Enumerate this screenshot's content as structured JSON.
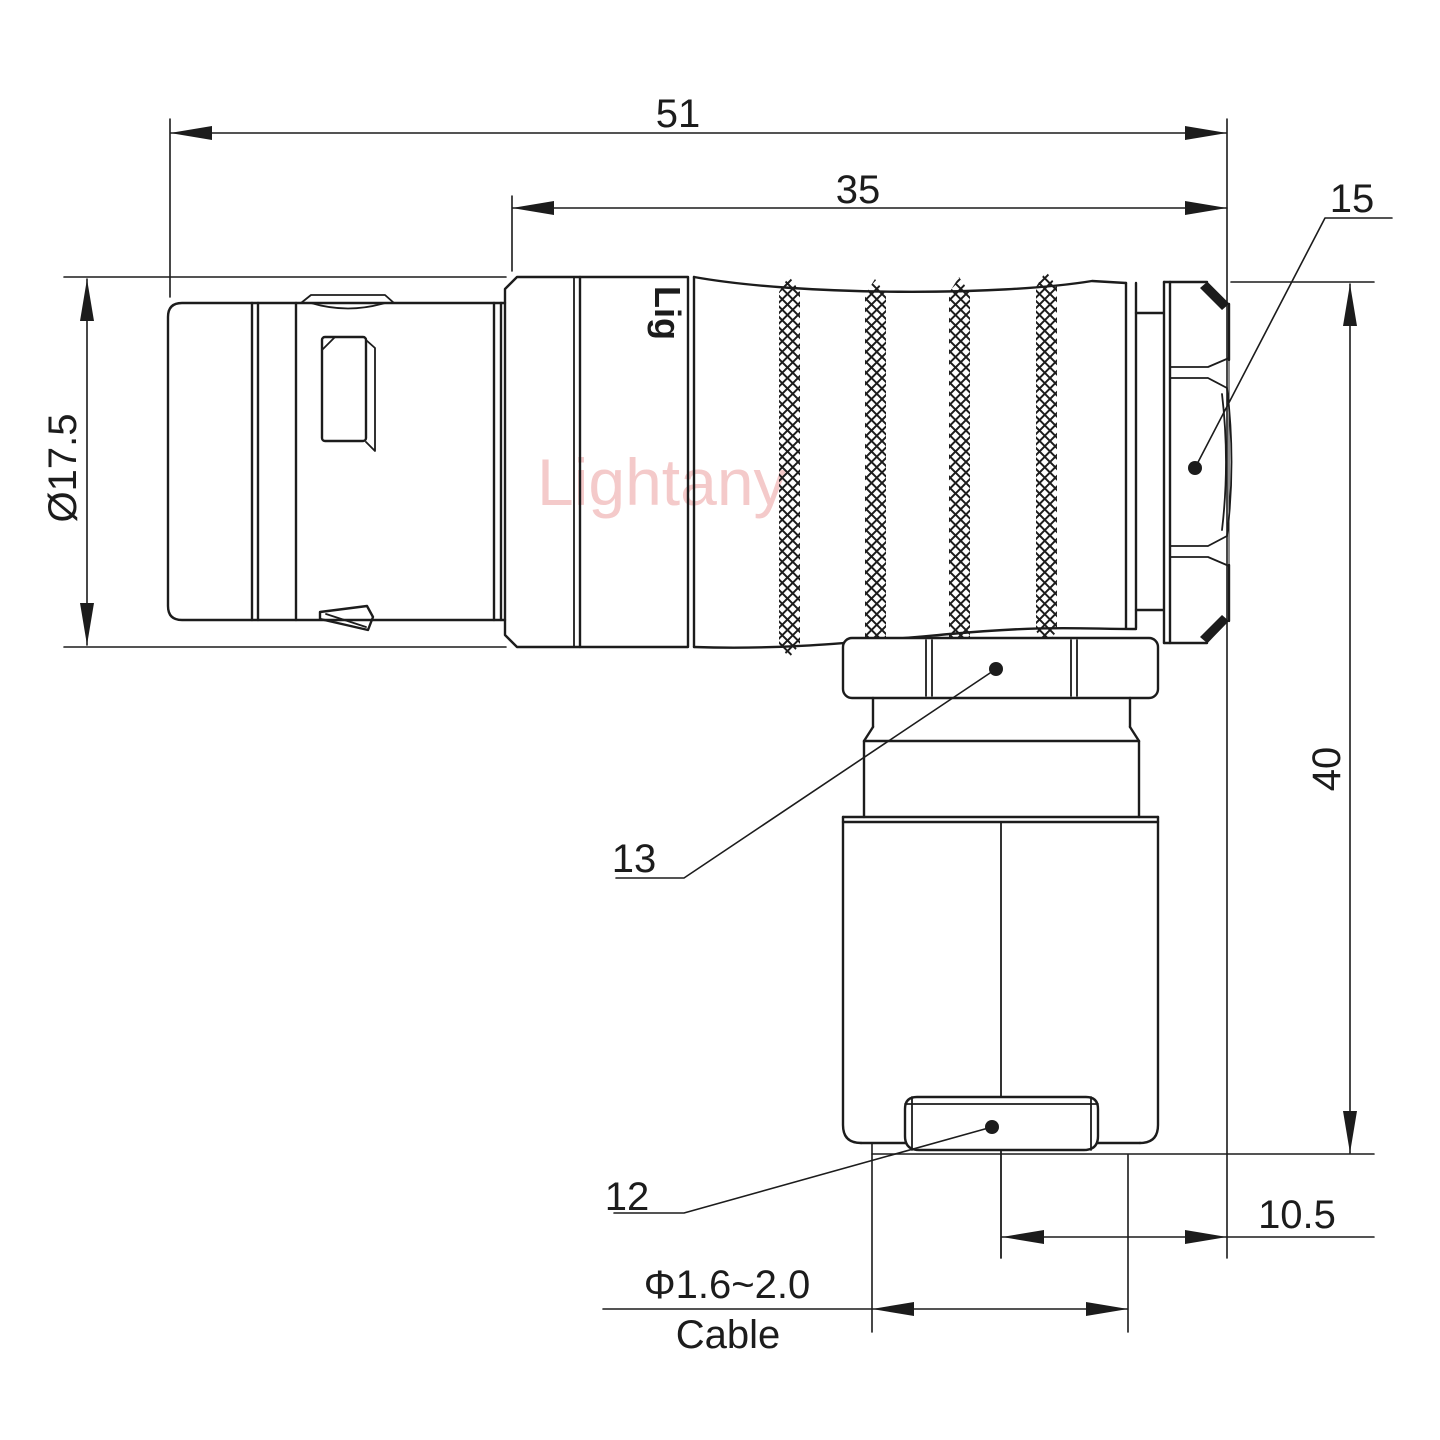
{
  "drawing": {
    "watermark": "Lightany",
    "body_marking": "Lig",
    "dims": {
      "overall_length": "51",
      "shell_length": "35",
      "backnut_callout": "15",
      "front_diameter": "Ø17.5",
      "height": "40",
      "nut_callout": "13",
      "clamp_callout": "12",
      "exit_offset": "10.5",
      "cable_range": "Φ1.6~2.0",
      "cable_word": "Cable"
    },
    "colors": {
      "line": "#1c1c1c",
      "watermark": "#f2bebe",
      "background": "#ffffff"
    }
  }
}
